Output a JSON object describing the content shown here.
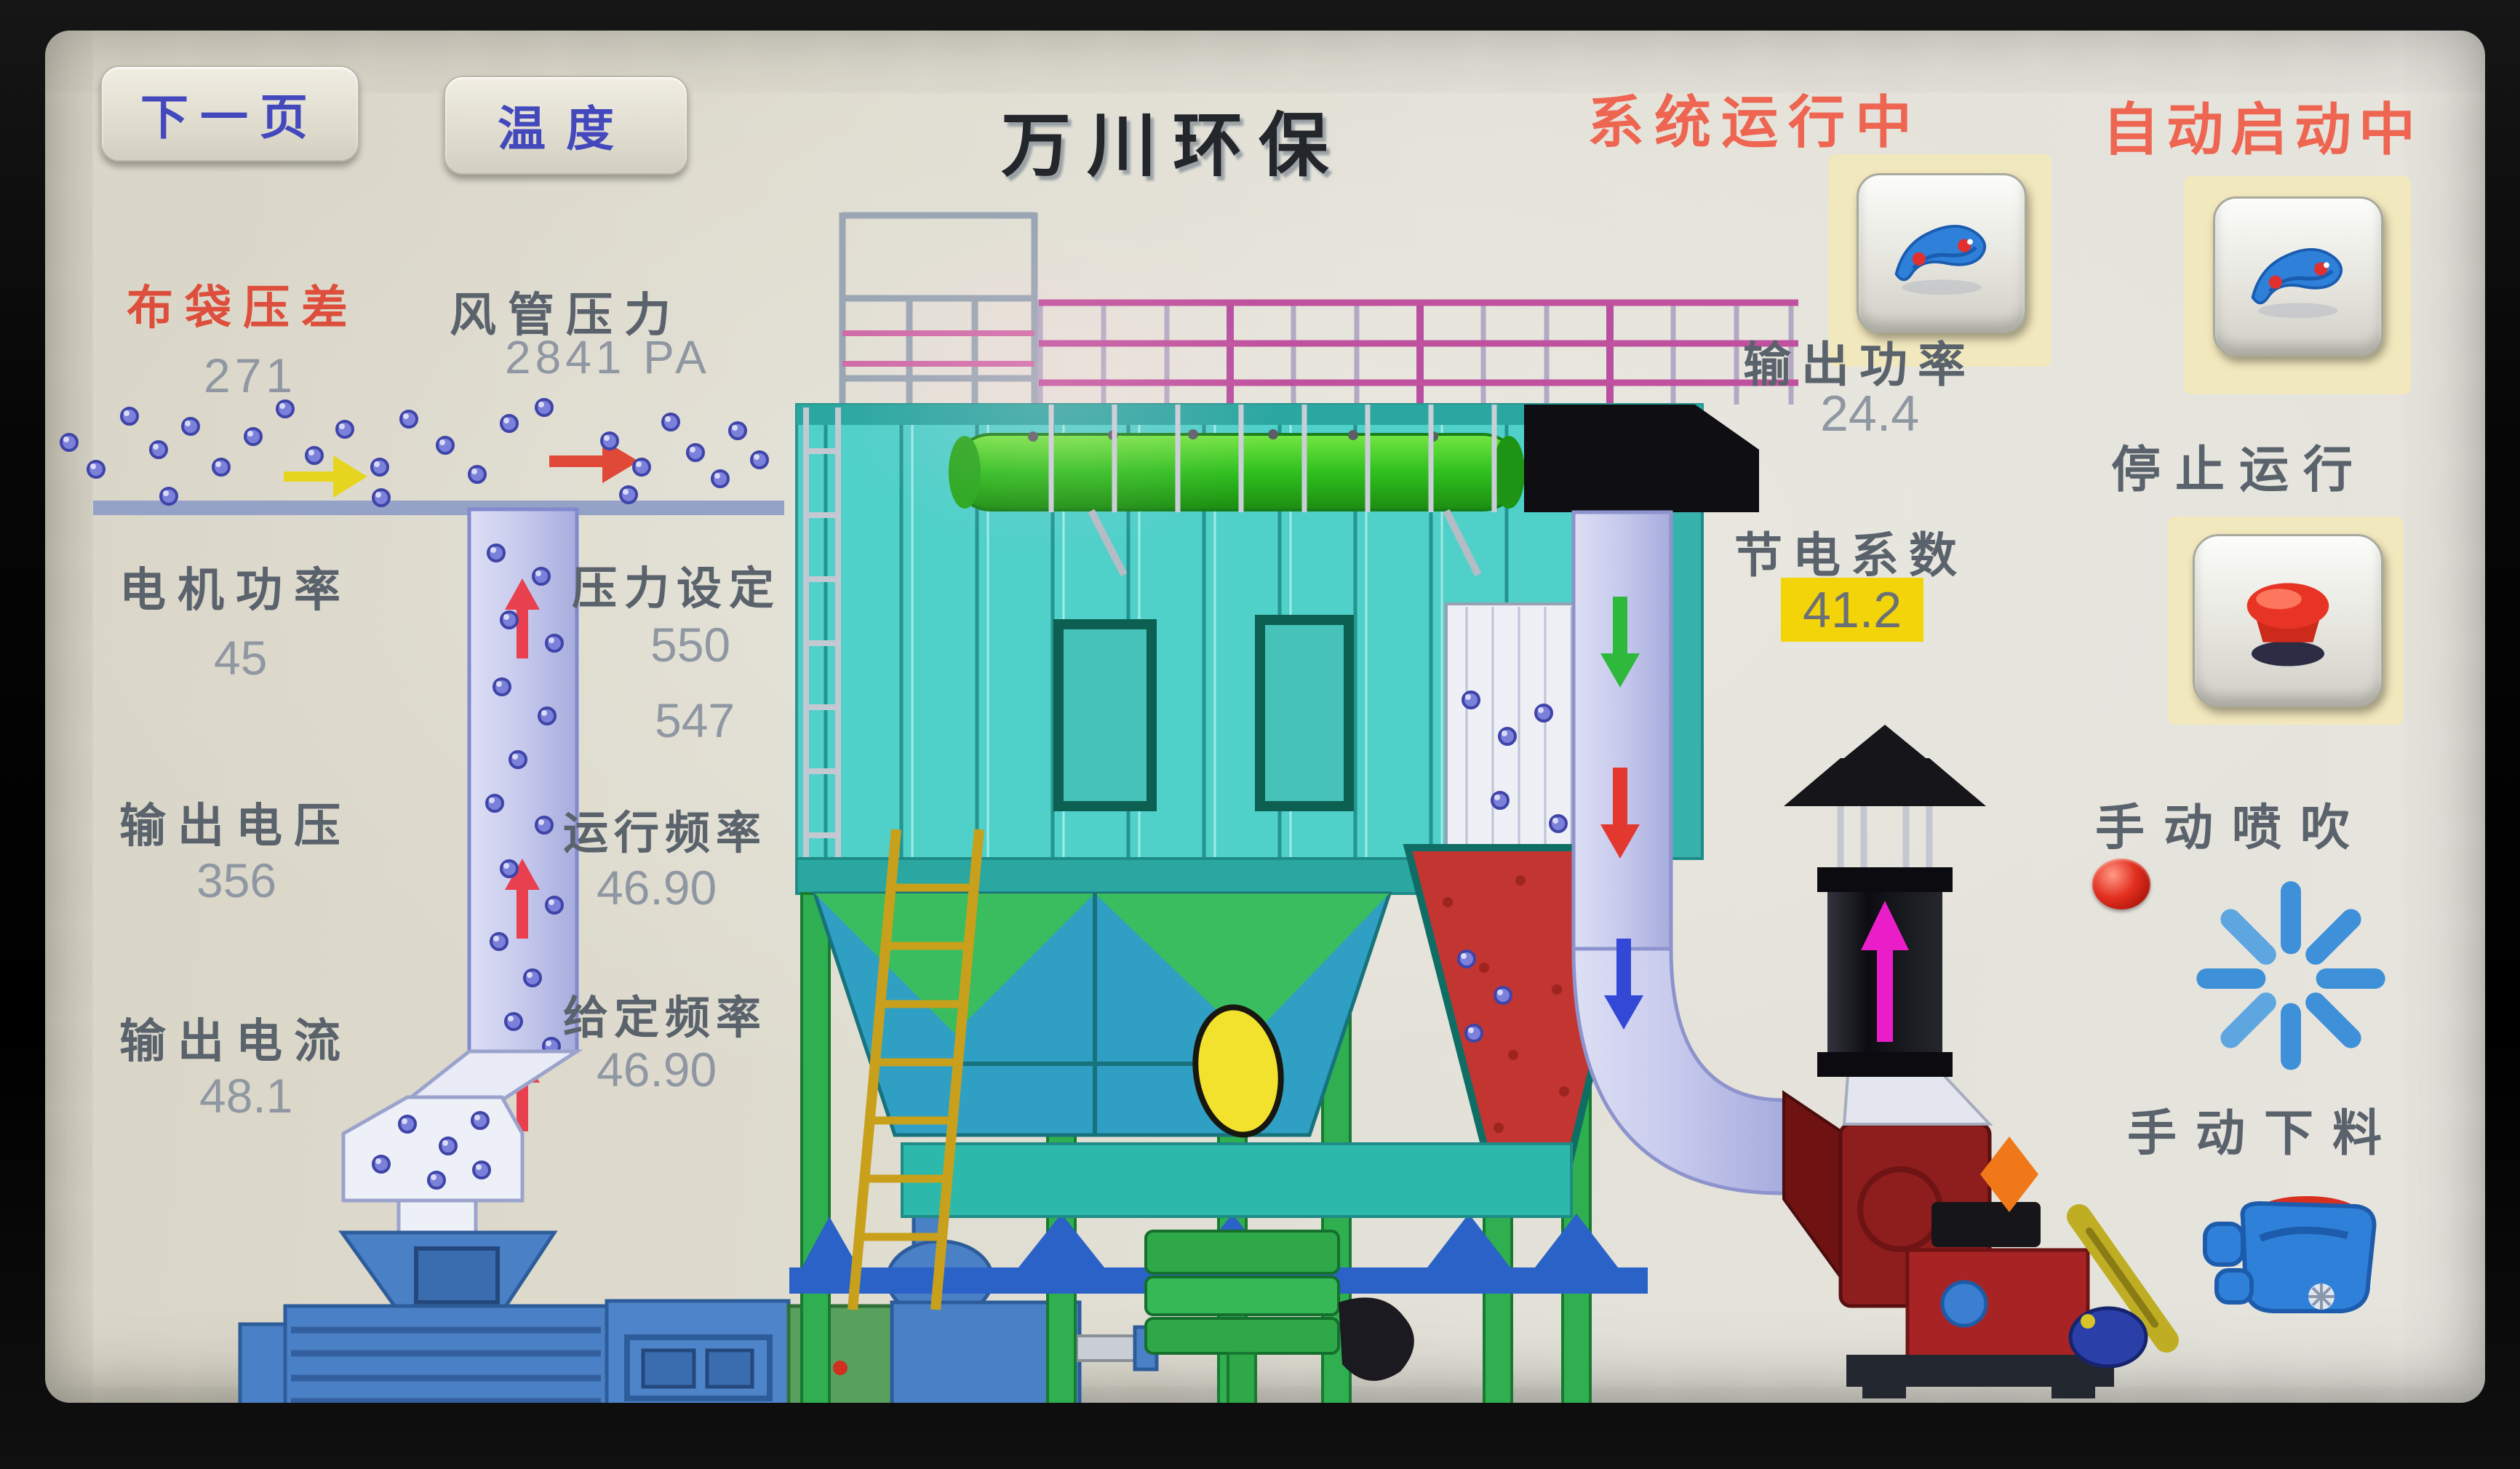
{
  "nav": {
    "next_page": "下一页",
    "temperature": "温度"
  },
  "app": {
    "title": "万川环保"
  },
  "status": {
    "system": "系统运行中",
    "auto": "自动启动中"
  },
  "gauges": {
    "bag_dp": {
      "label": "布袋压差",
      "value": "271"
    },
    "duct_pressure": {
      "label": "风管压力",
      "value": "2841 PA"
    },
    "motor_power": {
      "label": "电机功率",
      "value": "45"
    },
    "pressure_set": {
      "label": "压力设定",
      "setpoint": "550",
      "actual": "547"
    },
    "output_voltage": {
      "label": "输出电压",
      "value": "356"
    },
    "run_freq": {
      "label": "运行频率",
      "value": "46.90"
    },
    "output_current": {
      "label": "输出电流",
      "value": "48.1"
    },
    "set_freq": {
      "label": "给定频率",
      "value": "46.90"
    },
    "output_power": {
      "label": "输出功率",
      "value": "24.4"
    },
    "save_factor": {
      "label": "节电系数",
      "value": "41.2"
    }
  },
  "controls": {
    "stop": "停止运行",
    "manual_blow": "手动喷吹",
    "manual_discharge": "手动下料"
  },
  "icons": {
    "run_fan": "fan-icon",
    "auto_fan": "fan-icon",
    "stop": "emergency-stop-icon",
    "blow": "blow-pulse-starburst-icon",
    "blow_led": "indicator-led",
    "discharge": "discharge-valve-icon"
  },
  "colors": {
    "status_red": "#ee6552",
    "alert_label_red": "#dd4f3c",
    "label_gray": "#5a626c",
    "value_gray": "#8f97a2",
    "button_text_blue": "#4348bd",
    "highlight_yellow": "#f2d409",
    "tank_teal": "#4fd0c9",
    "pipe_lavender": "#c6c9ec",
    "fan_red": "#8e1d1d",
    "machine_blue": "#4a80c6",
    "leg_green": "#2faf4f"
  }
}
